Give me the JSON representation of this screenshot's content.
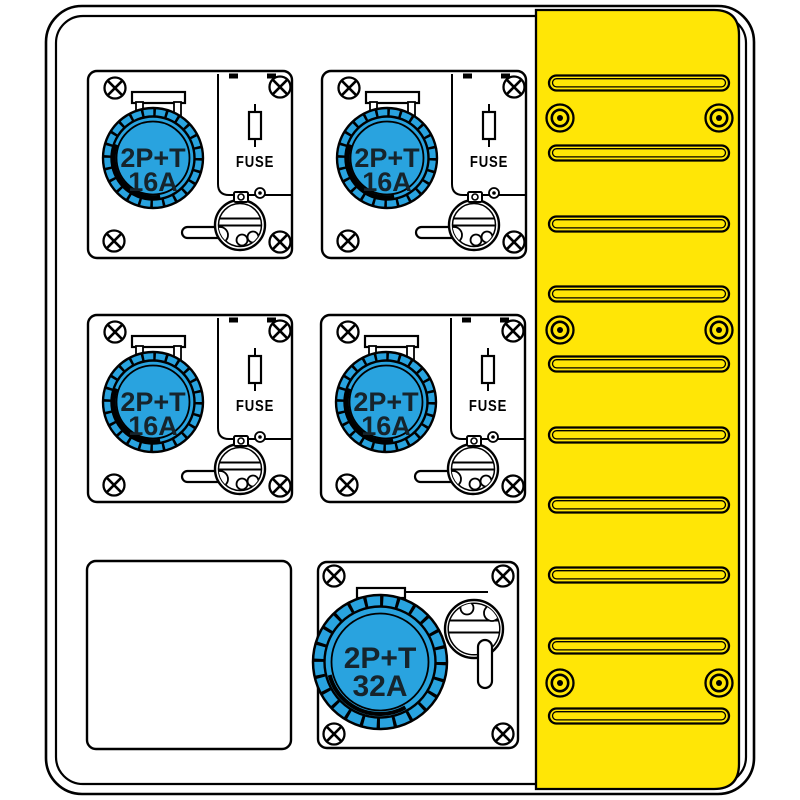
{
  "diagram": {
    "title": "distribution-board-front-view",
    "sockets_16a": {
      "count": 4,
      "label_line1": "2P+T",
      "label_line2": "16A",
      "fuse_label": "FUSE"
    },
    "socket_32a": {
      "count": 1,
      "label_line1": "2P+T",
      "label_line2": "32A"
    },
    "vent_panel": {
      "slot_count": 10,
      "screw_count": 6
    },
    "blank_plate_count": 1
  },
  "colors": {
    "socket_blue": "#29A3DF",
    "panel_yellow": "#FFE606",
    "outline": "#000000",
    "label_ink": "#16242C",
    "background": "#FFFFFF"
  }
}
